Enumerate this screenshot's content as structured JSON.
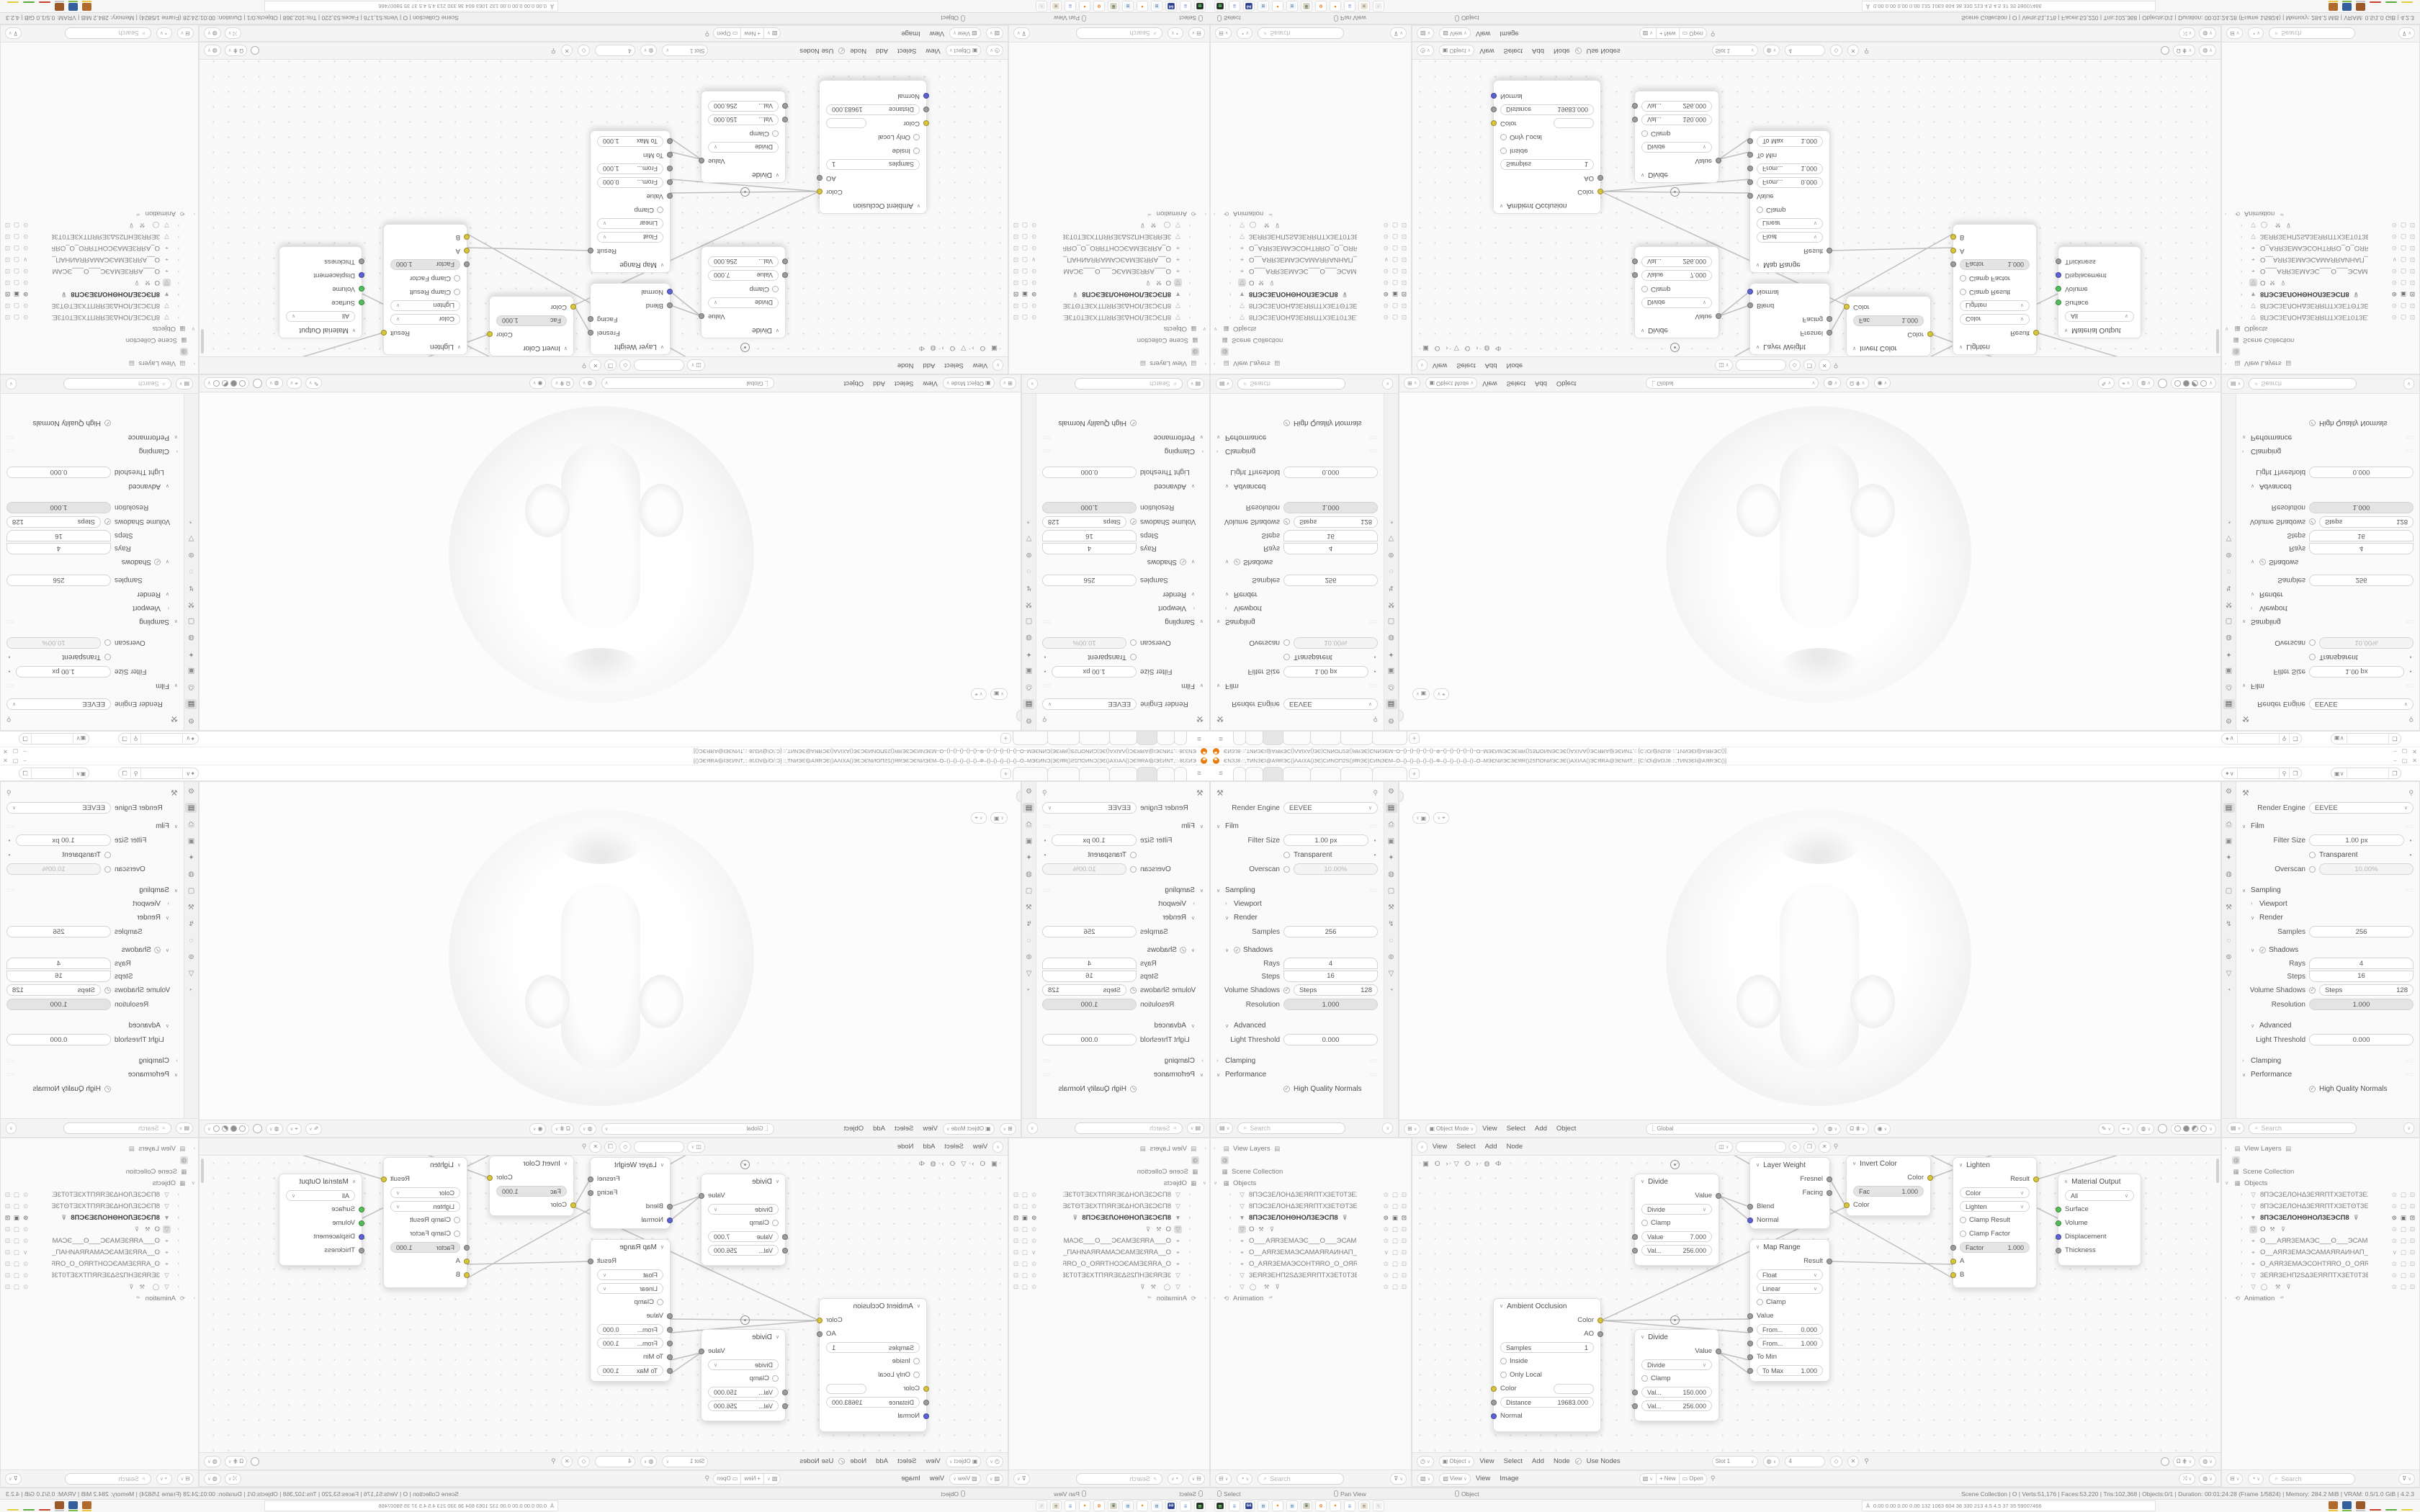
{
  "window": {
    "title": "ЄNЗJ8·::‚TИNЗЄI@AЯRЭC()ΛAIXA()ЗЄ)CИNOΠ2S()ЯRЗЄ)CИNЗЄM–O–()–()–()–()–()–Ф–()–()–()–()–()–O–MЗЄNИЭCЗЄЯR()2SΠONИЭCЗЄ()AXIΛA()ЭCЯRA@ЗЄNИT‚:: [C:\\O\\@ИЗJ8·::‚TИNЗЄI@AЯRЭC()]",
    "minimize": "–",
    "maximize": "▢",
    "close": "✕",
    "menu_icon": "≡",
    "add_tab": "+"
  },
  "topbar": {
    "scene_icon": "✦",
    "scene_value": "",
    "view_layer_icon": "▣",
    "view_layer_value": ""
  },
  "props": {
    "engine_label": "Render Engine",
    "engine_value": "EEVEE",
    "film": "Film",
    "filter_size_label": "Filter Size",
    "filter_size": "1.00 px",
    "transparent": "Transparent",
    "overscan_label": "Overscan",
    "overscan": "10.00%",
    "sampling": "Sampling",
    "viewport": "Viewport",
    "render": "Render",
    "samples_label": "Samples",
    "samples": "256",
    "shadows": "Shadows",
    "rays_label": "Rays",
    "rays": "4",
    "steps_label": "Steps",
    "steps": "16",
    "volume_shadows_label": "Volume Shadows",
    "vs_steps_label": "Steps",
    "vs_steps": "128",
    "resolution_label": "Resolution",
    "resolution": "1.000",
    "advanced": "Advanced",
    "light_threshold_label": "Light Threshold",
    "light_threshold": "0.000",
    "clamping": "Clamping",
    "performance": "Performance",
    "hq_normals": "High Quality Normals",
    "search_placeholder": "Search",
    "tab_icons": [
      "⚙",
      "▤",
      "⎙",
      "▣",
      "✦",
      "◍",
      "▢",
      "⚒",
      "↯",
      "◌",
      "⊚",
      "▽",
      "◔"
    ]
  },
  "viewport": {
    "mode": "Object Mode",
    "menu_view": "View",
    "menu_select": "Select",
    "menu_add": "Add",
    "menu_object": "Object",
    "orientation": "Global"
  },
  "node_editor": {
    "menu_view": "View",
    "menu_select": "Select",
    "menu_add": "Add",
    "menu_node": "Node",
    "use_nodes": "Use Nodes",
    "slot": "Slot 1",
    "id_value": "4",
    "obj_mode": "Object",
    "breadcrumb_1": "O",
    "breadcrumb_2": "O",
    "nodes": {
      "divide1": {
        "title": "Divide",
        "out": "Value",
        "op": "Divide",
        "clamp": "Clamp",
        "f1l": "Value",
        "f1v": "7.000",
        "f2l": "Val...",
        "f2v": "256.000"
      },
      "divide2": {
        "title": "Divide",
        "out": "Value",
        "op": "Divide",
        "clamp": "Clamp",
        "f1l": "Val...",
        "f1v": "150.000",
        "f2l": "Val...",
        "f2v": "256.000"
      },
      "layer_weight": {
        "title": "Layer Weight",
        "o1": "Fresnel",
        "o2": "Facing",
        "i1": "Blend",
        "i2": "Normal"
      },
      "map_range": {
        "title": "Map Range",
        "out": "Result",
        "t1": "Float",
        "t2": "Linear",
        "clamp": "Clamp",
        "value": "Value",
        "f1l": "From...",
        "f1v": "0.000",
        "f2l": "From...",
        "f2v": "1.000",
        "tomin": "To Min",
        "tomaxl": "To Max",
        "tomaxv": "1.000"
      },
      "invert": {
        "title": "Invert Color",
        "out": "Color",
        "facl": "Fac",
        "facv": "1.000",
        "in1": "Color"
      },
      "lighten": {
        "title": "Lighten",
        "out": "Result",
        "t1": "Color",
        "t2": "Lighten",
        "c1": "Clamp Result",
        "c2": "Clamp Factor",
        "fl": "Factor",
        "fv": "1.000",
        "a": "A",
        "b": "B"
      },
      "matout": {
        "title": "Material Output",
        "all": "All",
        "s": "Surface",
        "v": "Volume",
        "d": "Displacement",
        "t": "Thickness"
      },
      "ao": {
        "title": "Ambient Occlusion",
        "o1": "Color",
        "o2": "AO",
        "samplesl": "Samples",
        "samplesv": "1",
        "inside": "Inside",
        "only_local": "Only Local",
        "color_in": "Color",
        "distl": "Distance",
        "distv": "19683.000",
        "normal": "Normal"
      }
    }
  },
  "outliner": {
    "view_layers": "View Layers",
    "scene_collection": "Scene Collection",
    "objects": "Objects",
    "animation": "Animation",
    "search_placeholder": "Search",
    "items": [
      "8ПЭС3ЕЛОНΔ3ЕЯRПТХ3ЕТ0Т3ЕХТ",
      "8ПЭС3ЕЛОНΔ3ЕЯRПТХ3ЕТΘТ3ЕХТ",
      "8ПЭС3ЕЛОНΘНОЛ3ЕЭСП8",
      "O",
      "О___АЯR3ЕМАЭС___О___ЭСАМ3",
      "О__АЯR3ЕМАЭСАМАЯRАИНАП__С",
      "О_АЯR3ЕМАЭСОНТЯRО_О_ОЯRТН",
      "3ЕЯR3ЕНП2SΔ3ЕЯRПТХ3ЕТ0Т3ЕХТ",
      ""
    ]
  },
  "image_editor": {
    "mode": "View",
    "menu_view": "View",
    "menu_image": "Image",
    "new_label": "New",
    "open_label": "Open"
  },
  "status": {
    "hint_1": "Select",
    "hint_2": "Pan View",
    "hint_3": "Object",
    "stats": "Scene Collection | O | Verts:51,176 | Faces:53,220 | Tris:102,368 | Objects:0/1 | Duration: 00:01:24:28 (Frame 1/5824) | Memory: 284.2 MiB | VRAM: 0.5/1.0 GiB | 4.2.3"
  },
  "taskbar": {
    "monitor_text": "0.00 0.00 0.00 0.00  132 1063 604  38  330 213  4.5  4.5  37  35  59007466",
    "monitor_icon": "Å",
    "icons": [
      {
        "name": "fuse-emulator-icon",
        "bg": "#1c2a1c",
        "glyph": "▦",
        "fg": "#7ae07a"
      },
      {
        "name": "notepad-icon",
        "bg": "#ffffff",
        "glyph": "≣",
        "fg": "#7a9cc9"
      },
      {
        "name": "vice-c64-icon",
        "bg": "#2b3f8e",
        "glyph": "64",
        "fg": "#ffffff"
      },
      {
        "name": "calculator-icon",
        "bg": "#eef3f8",
        "glyph": "⊞",
        "fg": "#5b84b1"
      },
      {
        "name": "blender-icon",
        "bg": "#ffffff",
        "glyph": "●",
        "fg": "#e87d0d"
      },
      {
        "name": "calculator-icon-2",
        "bg": "#eef3f8",
        "glyph": "⊞",
        "fg": "#5b84b1"
      },
      {
        "name": "retro-pc-icon",
        "bg": "#d8d3c4",
        "glyph": "⌸",
        "fg": "#3d6b3d"
      },
      {
        "name": "firefox-icon",
        "bg": "#ffffff",
        "glyph": "❂",
        "fg": "#e66000"
      },
      {
        "name": "blender-icon-2",
        "bg": "#ffffff",
        "glyph": "●",
        "fg": "#e87d0d"
      },
      {
        "name": "notepad-icon-2",
        "bg": "#ffffff",
        "glyph": "≣",
        "fg": "#7a9cc9"
      },
      {
        "name": "scroll-printer-icon",
        "bg": "#e8e3d5",
        "glyph": "≋",
        "fg": "#8a7f66"
      },
      {
        "name": "gimp-icon",
        "bg": "#f0f0f0",
        "glyph": "✎",
        "fg": "#bdbdbd"
      }
    ],
    "tray_blocks": [
      {
        "bg": "#b06a2c",
        "ul": "#e8c93e"
      },
      {
        "bg": "#33609c",
        "ul": "#7ac143"
      },
      {
        "bg": "#9c5a28",
        "ul": "#c9c9c9"
      }
    ],
    "tray_dashes": [
      "#cc3b2f",
      "#58a83c",
      "#e0cf3c"
    ]
  }
}
